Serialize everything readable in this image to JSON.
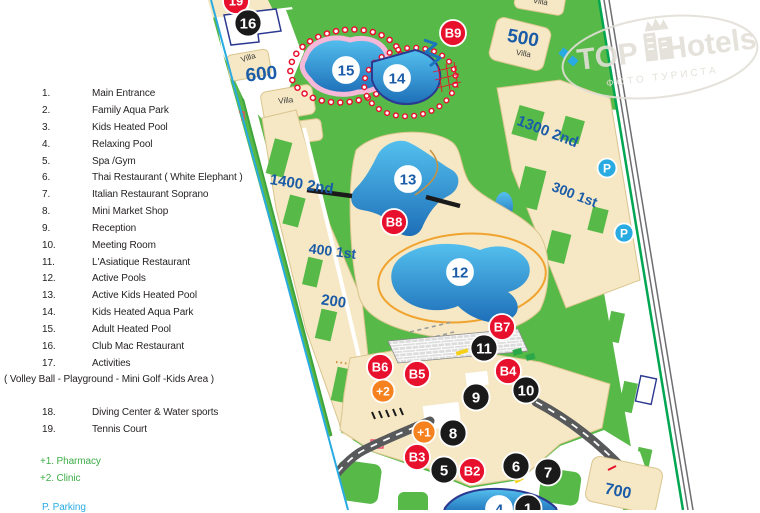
{
  "legend": {
    "rows": [
      {
        "y": 88,
        "num": "1.",
        "label": "Main Entrance"
      },
      {
        "y": 105,
        "num": "2.",
        "label": "Family Aqua Park"
      },
      {
        "y": 122,
        "num": "3.",
        "label": "Kids Heated Pool"
      },
      {
        "y": 139,
        "num": "4.",
        "label": "Relaxing  Pool"
      },
      {
        "y": 156,
        "num": "5.",
        "label": "Spa /Gym"
      },
      {
        "y": 172,
        "num": "6.",
        "label": "Thai Restaurant  ( White Elephant )"
      },
      {
        "y": 189,
        "num": "7.",
        "label": "Italian Restaurant  Soprano"
      },
      {
        "y": 206,
        "num": "8.",
        "label": "Mini Market Shop"
      },
      {
        "y": 223,
        "num": "9.",
        "label": "Reception"
      },
      {
        "y": 240,
        "num": "10.",
        "label": "Meeting Room"
      },
      {
        "y": 257,
        "num": "11.",
        "label": "L'Asiatique  Restaurant"
      },
      {
        "y": 273,
        "num": "12.",
        "label": "Active Pools"
      },
      {
        "y": 290,
        "num": "13.",
        "label": "Active Kids Heated Pool"
      },
      {
        "y": 307,
        "num": "14.",
        "label": "Kids Heated Aqua Park"
      },
      {
        "y": 324,
        "num": "15.",
        "label": "Adult Heated Pool"
      },
      {
        "y": 341,
        "num": "16.",
        "label": "Club Mac Restaurant"
      },
      {
        "y": 358,
        "num": "17.",
        "label": "Activities"
      },
      {
        "y": 374,
        "wide": true,
        "lx": 4,
        "label": "( Volley Ball - Playground - Mini Golf -Kids Area )"
      },
      {
        "y": 407,
        "num": "18.",
        "label": "Diving Center & Water sports"
      },
      {
        "y": 424,
        "num": "19.",
        "label": "Tennis Court"
      },
      {
        "y": 456,
        "wide": true,
        "lx": 40,
        "cls": "lg-green",
        "label": "+1. Pharmacy"
      },
      {
        "y": 473,
        "wide": true,
        "lx": 40,
        "cls": "lg-green",
        "label": "+2. Clinic"
      },
      {
        "y": 502,
        "wide": true,
        "lx": 42,
        "cls": "lg-blue",
        "label": "P.  Parking"
      }
    ]
  },
  "map": {
    "colors": {
      "grass_green": "#57B947",
      "building_cream": "#F6E8C4",
      "pool_blue_top": "#54C0EE",
      "pool_blue_bottom": "#1E6FB8",
      "road_gray": "#58595B",
      "boundary_green": "#00A651",
      "boundary_cyan": "#29ABE2",
      "badge_red": "#E8112D",
      "badge_black": "#1A1A1A",
      "badge_orange": "#F5821F",
      "parking_blue": "#29ABE2",
      "label_blue": "#1B5CA8"
    },
    "marker_styles": {
      "black": {
        "bg": "#1A1A1A",
        "fg": "#ffffff",
        "ring": "#ffffff",
        "r": 13.5,
        "fs": 15
      },
      "red": {
        "bg": "#E8112D",
        "fg": "#ffffff",
        "ring": "#ffffff",
        "r": 13,
        "fs": 13
      },
      "orange": {
        "bg": "#F5821F",
        "fg": "#ffffff",
        "ring": "#ffffff",
        "r": 11.5,
        "fs": 12
      },
      "pool": {
        "bg": "#ffffff",
        "fg": "#1B5CA8",
        "ring": "#ffffff",
        "r": 13,
        "fs": 15
      },
      "parking": {
        "bg": "#29ABE2",
        "fg": "#ffffff",
        "ring": "#ffffff",
        "r": 9.5,
        "fs": 12
      }
    },
    "markers": [
      {
        "label": "19",
        "type": "red",
        "x": 236,
        "y": 1
      },
      {
        "label": "16",
        "type": "black",
        "x": 248,
        "y": 23
      },
      {
        "label": "B9",
        "type": "red",
        "x": 453,
        "y": 33
      },
      {
        "label": "15",
        "type": "pool",
        "x": 346,
        "y": 70
      },
      {
        "label": "14",
        "type": "pool",
        "x": 397,
        "y": 78
      },
      {
        "label": "13",
        "type": "pool",
        "x": 408,
        "y": 179
      },
      {
        "label": "B8",
        "type": "red",
        "x": 394,
        "y": 222
      },
      {
        "label": "12",
        "type": "pool",
        "x": 460,
        "y": 272
      },
      {
        "label": "B7",
        "type": "red",
        "x": 502,
        "y": 327
      },
      {
        "label": "11",
        "type": "black",
        "x": 484,
        "y": 348
      },
      {
        "label": "B6",
        "type": "red",
        "x": 380,
        "y": 367
      },
      {
        "label": "B5",
        "type": "red",
        "x": 417,
        "y": 374
      },
      {
        "label": "B4",
        "type": "red",
        "x": 508,
        "y": 371
      },
      {
        "label": "+2",
        "type": "orange",
        "x": 383,
        "y": 391
      },
      {
        "label": "9",
        "type": "black",
        "x": 476,
        "y": 397
      },
      {
        "label": "10",
        "type": "black",
        "x": 526,
        "y": 390
      },
      {
        "label": "+1",
        "type": "orange",
        "x": 424,
        "y": 432
      },
      {
        "label": "8",
        "type": "black",
        "x": 453,
        "y": 433
      },
      {
        "label": "B3",
        "type": "red",
        "x": 417,
        "y": 457
      },
      {
        "label": "5",
        "type": "black",
        "x": 444,
        "y": 470
      },
      {
        "label": "B2",
        "type": "red",
        "x": 472,
        "y": 471
      },
      {
        "label": "6",
        "type": "black",
        "x": 516,
        "y": 466
      },
      {
        "label": "7",
        "type": "black",
        "x": 548,
        "y": 472
      },
      {
        "label": "4",
        "type": "pool",
        "x": 499,
        "y": 509
      },
      {
        "label": "1",
        "type": "black",
        "x": 528,
        "y": 508
      },
      {
        "label": "P",
        "type": "parking",
        "x": 607,
        "y": 168
      },
      {
        "label": "P",
        "type": "parking",
        "x": 624,
        "y": 233
      }
    ],
    "labels": [
      {
        "text": "600",
        "x": 262,
        "y": 80,
        "size": 19,
        "rot": -6
      },
      {
        "text": "Villa",
        "x": 249,
        "y": 60,
        "size": 8,
        "rot": -18,
        "cls": "villa"
      },
      {
        "text": "Villa",
        "x": 286,
        "y": 103,
        "size": 8,
        "rot": -6,
        "cls": "villa"
      },
      {
        "text": "Villa",
        "x": 540,
        "y": 4,
        "size": 8,
        "rot": 10,
        "cls": "villa"
      },
      {
        "text": "500",
        "x": 522,
        "y": 44,
        "size": 19,
        "rot": 10
      },
      {
        "text": "Villa",
        "x": 523,
        "y": 56,
        "size": 8,
        "rot": 10,
        "cls": "villa"
      },
      {
        "text": "1300 2nd",
        "x": 546,
        "y": 136,
        "size": 15,
        "rot": 21
      },
      {
        "text": "300 1st",
        "x": 573,
        "y": 199,
        "size": 14,
        "rot": 21
      },
      {
        "text": "1400 2nd",
        "x": 301,
        "y": 189,
        "size": 15,
        "rot": 9
      },
      {
        "text": "400 1st",
        "x": 332,
        "y": 256,
        "size": 14,
        "rot": 7
      },
      {
        "text": "200",
        "x": 333,
        "y": 306,
        "size": 15,
        "rot": 8
      },
      {
        "text": "700",
        "x": 617,
        "y": 496,
        "size": 16,
        "rot": 12
      }
    ],
    "watermark": {
      "brand_left": "TOP",
      "brand_right": "Hotels",
      "tagline": "ФОТО ТУРИСТА"
    }
  }
}
